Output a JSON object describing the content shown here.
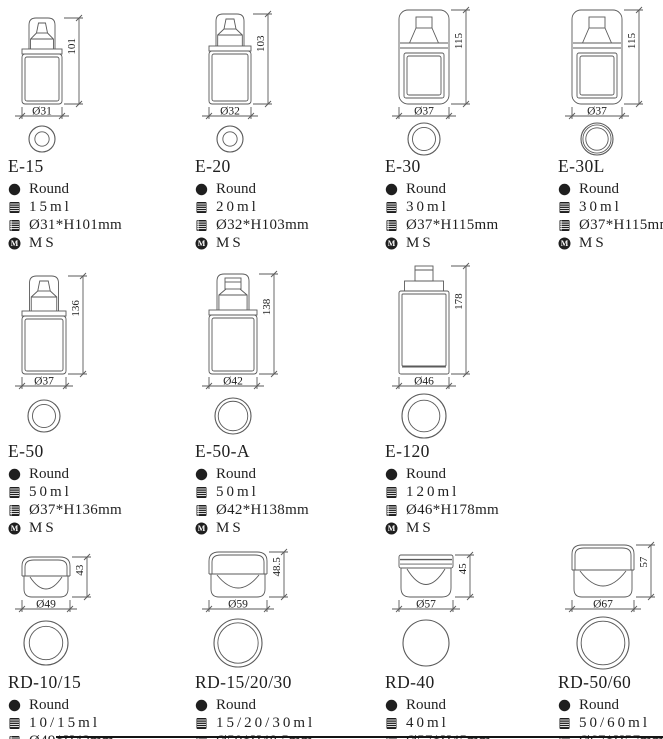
{
  "page": {
    "background": "#ffffff",
    "text_color": "#1f1f1f",
    "line_color": "#5a5a5a",
    "material_icon_letter": "M"
  },
  "products": [
    {
      "row": 1,
      "name": "E-15",
      "shape": "Round",
      "volume": "15ml",
      "size": "Ø31*H101mm",
      "material": "MS",
      "drawing": {
        "type": "stepped_pump",
        "w": 40,
        "h": 86,
        "height_label": "101",
        "diameter_label": "Ø31",
        "circle_d": 26,
        "rings": [
          1.0,
          0.55
        ]
      }
    },
    {
      "row": 1,
      "name": "E-20",
      "shape": "Round",
      "volume": "20ml",
      "size": "Ø32*H103mm",
      "material": "MS",
      "drawing": {
        "type": "stepped_pump",
        "w": 42,
        "h": 90,
        "height_label": "103",
        "diameter_label": "Ø32",
        "circle_d": 26,
        "rings": [
          1.0,
          0.55
        ]
      }
    },
    {
      "row": 1,
      "name": "E-30",
      "shape": "Round",
      "volume": "30ml",
      "size": "Ø37*H115mm",
      "material": "MS",
      "drawing": {
        "type": "capsule",
        "w": 50,
        "h": 94,
        "height_label": "115",
        "diameter_label": "Ø37",
        "circle_d": 32,
        "rings": [
          1.0,
          0.72
        ]
      }
    },
    {
      "row": 1,
      "name": "E-30L",
      "shape": "Round",
      "volume": "30ml",
      "size": "Ø37*H115mm",
      "material": "MS",
      "drawing": {
        "type": "capsule",
        "w": 50,
        "h": 94,
        "height_label": "115",
        "diameter_label": "Ø37",
        "circle_d": 32,
        "rings": [
          1.0,
          0.88,
          0.7
        ]
      }
    },
    {
      "row": 2,
      "name": "E-50",
      "shape": "Round",
      "volume": "50ml",
      "size": "Ø37*H136mm",
      "material": "MS",
      "drawing": {
        "type": "stepped_pump",
        "w": 44,
        "h": 98,
        "height_label": "136",
        "diameter_label": "Ø37",
        "circle_d": 32,
        "rings": [
          1.0,
          0.72
        ]
      }
    },
    {
      "row": 2,
      "name": "E-50-A",
      "shape": "Round",
      "volume": "50ml",
      "size": "Ø42*H138mm",
      "material": "MS",
      "drawing": {
        "type": "stepped_flat",
        "w": 48,
        "h": 100,
        "height_label": "138",
        "diameter_label": "Ø42",
        "circle_d": 36,
        "rings": [
          1.0,
          0.82
        ]
      }
    },
    {
      "row": 2,
      "name": "E-120",
      "shape": "Round",
      "volume": "120ml",
      "size": "Ø46*H178mm",
      "material": "MS",
      "drawing": {
        "type": "tall_pump",
        "w": 50,
        "h": 108,
        "height_label": "178",
        "diameter_label": "Ø46",
        "circle_d": 44,
        "rings": [
          1.0,
          0.72
        ]
      }
    },
    {
      "row": 3,
      "name": "RD-10/15",
      "shape": "Round",
      "volume": "10/15ml",
      "size": "Ø49*H43mm",
      "material": "MS",
      "drawing": {
        "type": "jar_dome",
        "w": 48,
        "h": 40,
        "height_label": "43",
        "diameter_label": "Ø49",
        "circle_d": 44,
        "rings": [
          1.0,
          0.76
        ]
      }
    },
    {
      "row": 3,
      "name": "RD-15/20/30",
      "shape": "Round",
      "volume": "15/20/30ml",
      "size": "Ø59*H48.5mm",
      "material": "MS",
      "drawing": {
        "type": "jar_dome",
        "w": 58,
        "h": 45,
        "height_label": "48.5",
        "diameter_label": "Ø59",
        "circle_d": 48,
        "rings": [
          1.0,
          0.84
        ]
      }
    },
    {
      "row": 3,
      "name": "RD-40",
      "shape": "Round",
      "volume": "40ml",
      "size": "Ø57*H45mm",
      "material": "ABS",
      "drawing": {
        "type": "jar_flat",
        "w": 54,
        "h": 42,
        "height_label": "45",
        "diameter_label": "Ø57",
        "circle_d": 46,
        "rings": [
          1.0
        ]
      }
    },
    {
      "row": 3,
      "name": "RD-50/60",
      "shape": "Round",
      "volume": "50/60ml",
      "size": "Ø67*H57mm",
      "material": "MS",
      "drawing": {
        "type": "jar_dome",
        "w": 62,
        "h": 52,
        "height_label": "57",
        "diameter_label": "Ø67",
        "circle_d": 52,
        "rings": [
          1.0,
          0.84
        ]
      }
    }
  ]
}
